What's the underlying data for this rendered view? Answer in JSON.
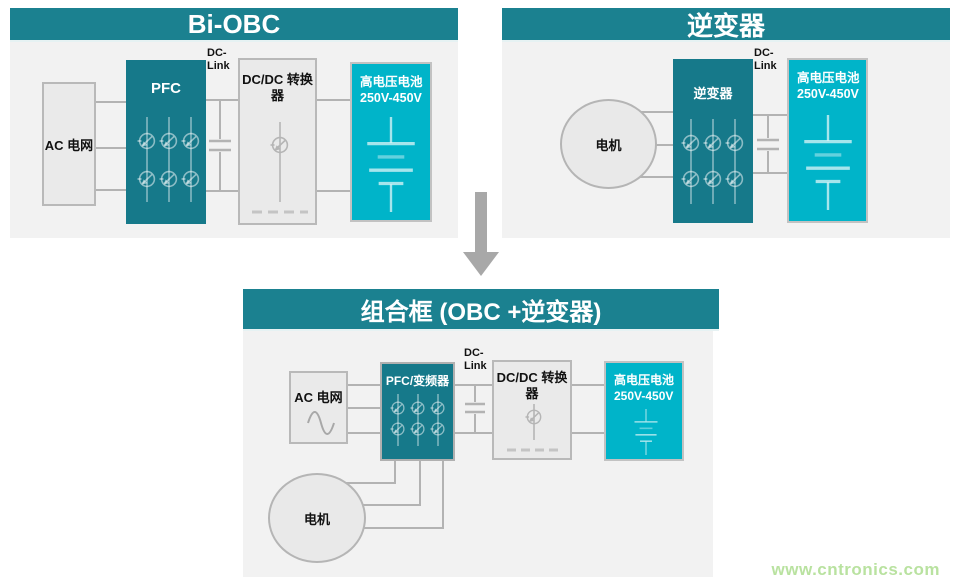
{
  "colors": {
    "header_teal": "#1b8190",
    "block_teal": "#16798a",
    "battery_cyan": "#00b4c9",
    "panel_bg": "#f2f2f2",
    "wire_gray": "#b3b3b3",
    "arrow_gray": "#a8a8a8",
    "watermark_green": "#b9e2a0"
  },
  "panel_bi_obc": {
    "title": "Bi-OBC",
    "ac_grid_label": "AC 电网",
    "pfc_label": "PFC",
    "dc_link_line1": "DC-",
    "dc_link_line2": "Link",
    "dcdc_label_line1": "DC/DC 转换",
    "dcdc_label_line2": "器",
    "battery_label_line1": "高电压电池",
    "battery_label_line2": "250V-450V"
  },
  "panel_inverter": {
    "title": "逆变器",
    "motor_label": "电机",
    "inverter_label": "逆变器",
    "dc_link_line1": "DC-",
    "dc_link_line2": "Link",
    "battery_label_line1": "高电压电池",
    "battery_label_line2": "250V-450V"
  },
  "panel_combo": {
    "title": "组合框 (OBC +逆变器)",
    "ac_grid_label": "AC 电网",
    "pfc_label": "PFC/变频器",
    "dc_link_line1": "DC-",
    "dc_link_line2": "Link",
    "dcdc_label_line1": "DC/DC 转换",
    "dcdc_label_line2": "器",
    "battery_label_line1": "高电压电池",
    "battery_label_line2": "250V-450V",
    "motor_label": "电机"
  },
  "watermark": {
    "text": "www.cntronics.com"
  }
}
